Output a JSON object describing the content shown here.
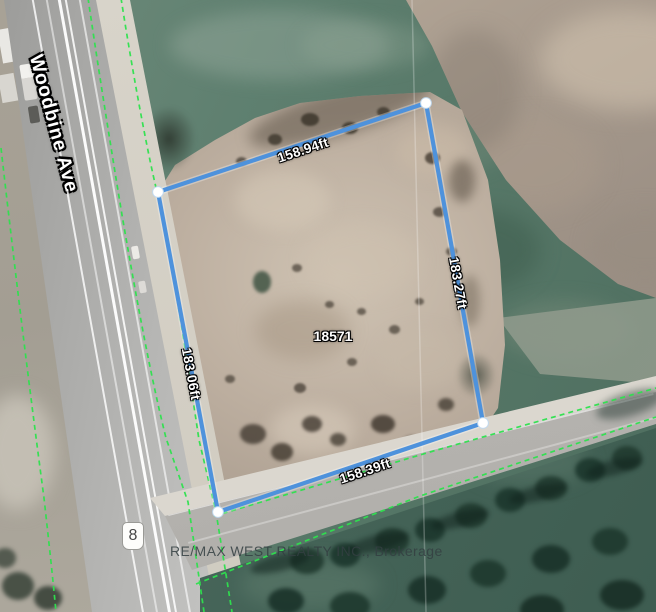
{
  "map": {
    "street_label": "Woodbine Ave",
    "route_shield_label": "8",
    "parcel_id_label": "18571",
    "watermark_text": "RE/MAX WEST REALTY INC., Brokerage",
    "measurements": {
      "top": "158.94ft",
      "right": "183.27ft",
      "bottom": "158.39ft",
      "left": "183.06ft"
    },
    "colors": {
      "boundary_blue": "#4e92dc",
      "vertex_dot": "#ffffff",
      "parcel_line_green": "#2ee24e",
      "field_green": "#5d7d6d",
      "dirt_tan": "#bcae9f",
      "plowed_brown": "#a1948a",
      "road_gray": "#b3b3b1",
      "forest_green": "#47665a"
    }
  }
}
